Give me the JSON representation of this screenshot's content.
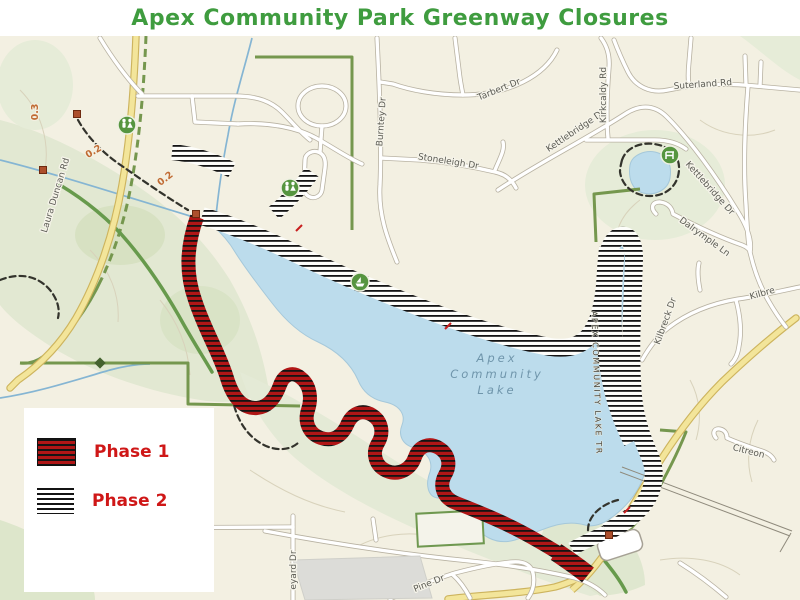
{
  "title": "Apex Community Park Greenway Closures",
  "colors": {
    "title_green": "#3f9c3f",
    "legend_red": "#cf1717",
    "phase1_red": "#b01616",
    "hatch_black": "#141414",
    "lake_blue": "#bcdcec",
    "boundary_green": "#75974e",
    "distance_orange": "#c06a32"
  },
  "legend": {
    "items": [
      {
        "id": "phase1",
        "label": "Phase 1"
      },
      {
        "id": "phase2",
        "label": "Phase 2"
      }
    ]
  },
  "map": {
    "labels": [
      {
        "text": "Laura Duncan Rd",
        "x": 58,
        "y": 196,
        "rot": -73,
        "cls": "road"
      },
      {
        "text": "Burntey Dr",
        "x": 384,
        "y": 122,
        "rot": -86,
        "cls": "road"
      },
      {
        "text": "Tarbert Dr",
        "x": 500,
        "y": 92,
        "rot": -22,
        "cls": "road"
      },
      {
        "text": "Stoneleigh Dr",
        "x": 448,
        "y": 164,
        "rot": 9,
        "cls": "road"
      },
      {
        "text": "Kettlebridge Dr",
        "x": 577,
        "y": 133,
        "rot": -34,
        "cls": "road"
      },
      {
        "text": "Kettlebridge Dr",
        "x": 708,
        "y": 190,
        "rot": 48,
        "cls": "road"
      },
      {
        "text": "Kirkcaldy Rd",
        "x": 606,
        "y": 95,
        "rot": -90,
        "cls": "road"
      },
      {
        "text": "Suterland Rd",
        "x": 703,
        "y": 87,
        "rot": -4,
        "cls": "road"
      },
      {
        "text": "Dalrymple Ln",
        "x": 703,
        "y": 239,
        "rot": 36,
        "cls": "road"
      },
      {
        "text": "Kilbreck Dr",
        "x": 668,
        "y": 322,
        "rot": -70,
        "cls": "road"
      },
      {
        "text": "Kilbre",
        "x": 763,
        "y": 296,
        "rot": -16,
        "cls": "road"
      },
      {
        "text": "Citreon",
        "x": 748,
        "y": 454,
        "rot": 14,
        "cls": "road"
      },
      {
        "text": "eyard Dr",
        "x": 296,
        "y": 570,
        "rot": -90,
        "cls": "road"
      },
      {
        "text": "Pine Dr",
        "x": 430,
        "y": 586,
        "rot": -22,
        "cls": "road"
      },
      {
        "text": "0.3",
        "x": 38,
        "y": 112,
        "rot": -90,
        "cls": "dist"
      },
      {
        "text": "0.2",
        "x": 95,
        "y": 154,
        "rot": -30,
        "cls": "dist"
      },
      {
        "text": "0.2",
        "x": 167,
        "y": 181,
        "rot": -38,
        "cls": "dist"
      },
      {
        "text": "Apex",
        "x": 497,
        "y": 362,
        "rot": 0,
        "cls": "lake"
      },
      {
        "text": "Community",
        "x": 497,
        "y": 378,
        "rot": 0,
        "cls": "lake"
      },
      {
        "text": "Lake",
        "x": 497,
        "y": 394,
        "rot": 0,
        "cls": "lake"
      },
      {
        "text": "APEX COMMUNITY LAKE TR",
        "x": 594,
        "y": 383,
        "rot": 88,
        "cls": "laketrail"
      }
    ],
    "icons": [
      {
        "type": "restroom",
        "x": 127,
        "y": 125
      },
      {
        "type": "restroom",
        "x": 290,
        "y": 188
      },
      {
        "type": "boat",
        "x": 360,
        "y": 282
      },
      {
        "type": "bench",
        "x": 670,
        "y": 155
      }
    ],
    "trailhead_squares": [
      [
        77,
        114
      ],
      [
        43,
        170
      ],
      [
        196,
        214
      ],
      [
        609,
        535
      ]
    ],
    "boundary_markers": [
      [
        100,
        363
      ]
    ],
    "mile_ticks": [
      [
        299,
        228
      ],
      [
        448,
        326
      ],
      [
        627,
        510
      ]
    ]
  }
}
